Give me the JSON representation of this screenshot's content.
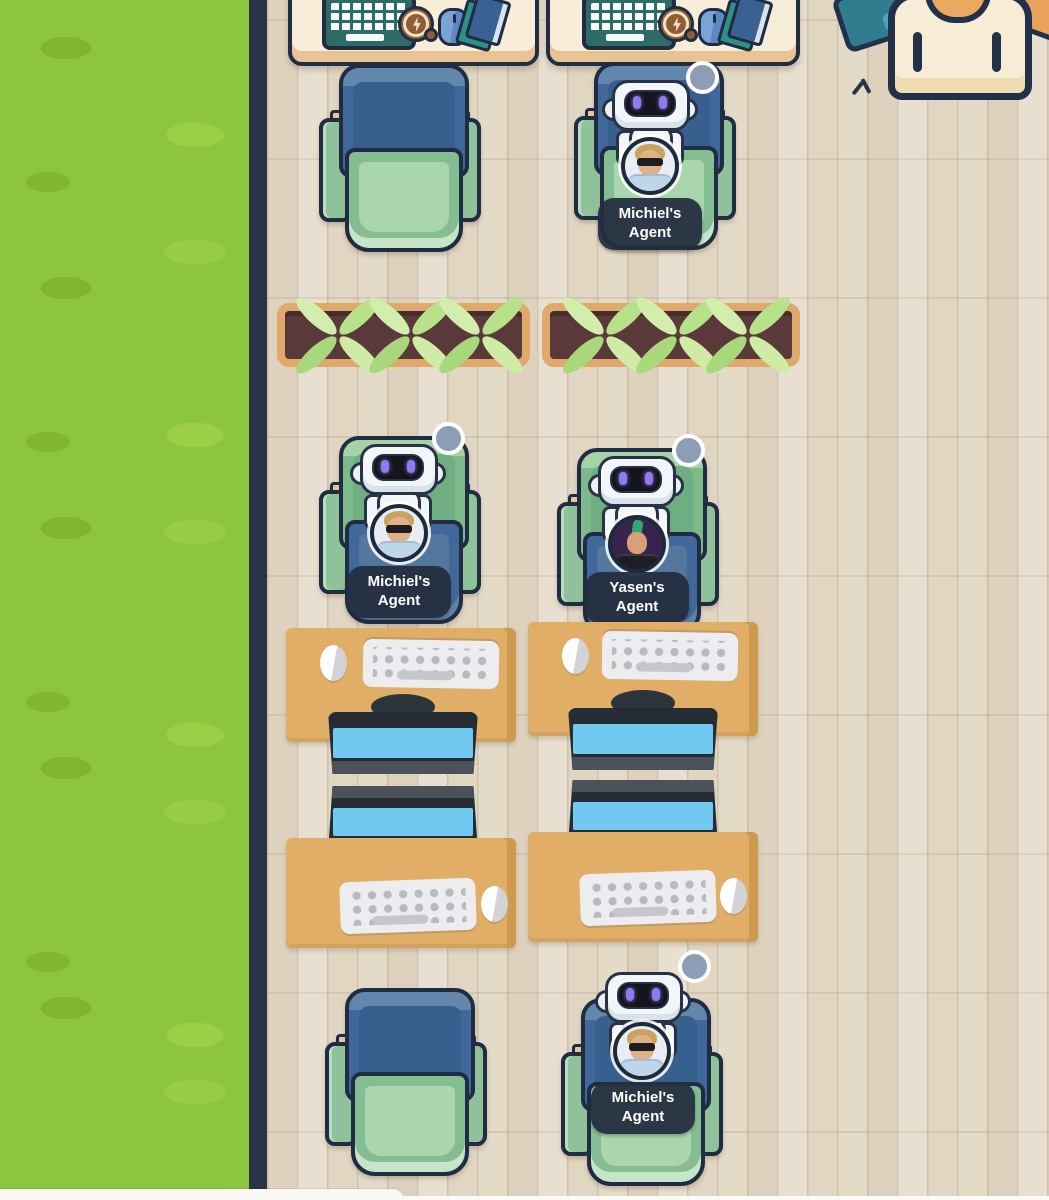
{
  "scene": {
    "name": "virtual-office-floor",
    "colors": {
      "grass": "#8CC63F",
      "wall": "#2A3447",
      "floor_wood": "#E4DAC8",
      "desk_cream": "#F7EDD9",
      "desk_tan": "#E0AE66",
      "chair_blue": "#41689B",
      "chair_green": "#85BD93",
      "monitor_screen": "#6FC9F1",
      "label_background": "#242E3E",
      "label_text": "#FFFFFF",
      "status_dot": "#8C9DB5",
      "robot_eye": "#8F7BF0",
      "planter_rim": "#DFA96B",
      "planter_soil": "#5A393A"
    }
  },
  "agents": [
    {
      "id": "agent-top",
      "label": "Michiel's Agent",
      "avatar": "man-sunglasses"
    },
    {
      "id": "agent-mid-left",
      "label": "Michiel's Agent",
      "avatar": "man-sunglasses"
    },
    {
      "id": "agent-mid-right",
      "label": "Yasen's Agent",
      "avatar": "punk-green-hair"
    },
    {
      "id": "agent-bottom",
      "label": "Michiel's Agent",
      "avatar": "man-sunglasses"
    }
  ]
}
